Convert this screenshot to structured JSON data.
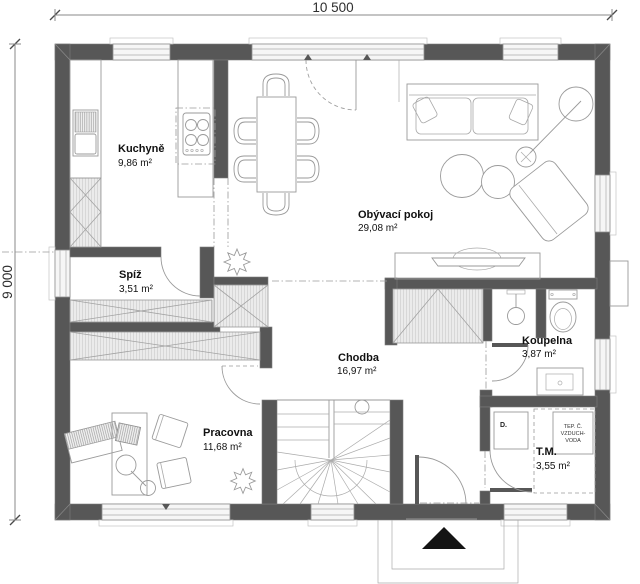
{
  "plan": {
    "dimensions": {
      "width": "10 500",
      "height": "9 000"
    },
    "rooms": {
      "kuchyne": {
        "name": "Kuchyně",
        "area": "9,86 m²"
      },
      "spiz": {
        "name": "Spíž",
        "area": "3,51 m²"
      },
      "obyvaci_pokoj": {
        "name": "Obývací pokoj",
        "area": "29,08 m²"
      },
      "chodba": {
        "name": "Chodba",
        "area": "16,97 m²"
      },
      "pracovna": {
        "name": "Pracovna",
        "area": "11,68 m²"
      },
      "koupelna": {
        "name": "Koupelna",
        "area": "3,87 m²"
      },
      "tm": {
        "name": "T.M.",
        "area": "3,55 m²"
      }
    },
    "equipment": {
      "dryer": "D.",
      "heat_pump": {
        "line1": "TEP. Č.",
        "line2": "VZDUCH-",
        "line3": "VODA"
      }
    },
    "colors": {
      "wall": "#575757",
      "line": "#8f8f8f",
      "hatch_fill": "#ebebeb",
      "text": "#111111"
    }
  }
}
